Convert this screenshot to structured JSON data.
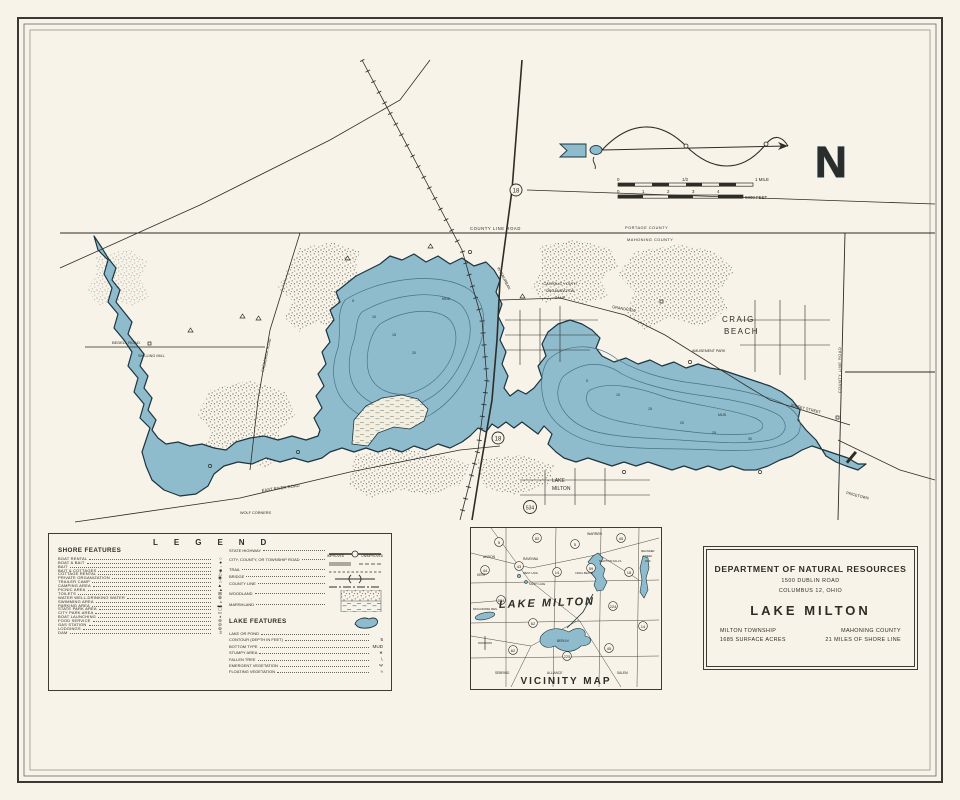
{
  "colors": {
    "paper": "#f7f3e8",
    "water": "#8ebccd",
    "ink": "#2e2c27",
    "contour": "#477484"
  },
  "compass": {
    "n": "N"
  },
  "scalebar": {
    "zero": "0",
    "half": "1/2",
    "mile": "1 MILE",
    "feet_ticks": [
      "0",
      "1",
      "2",
      "3",
      "4"
    ],
    "feet": "5000 FEET"
  },
  "map": {
    "county_line_road": "COUNTY LINE ROAD",
    "portage_county": "PORTAGE COUNTY",
    "mahoning_county": "MAHONING COUNTY",
    "county_line_road_vertical": "COUNTY LINE ROAD",
    "bedell_road": "BEDELL ROAD",
    "shilling_mill": "SHILLING MILL",
    "frederick_road": "FREDERICK ROAD",
    "east_river_road": "EAST RIVER ROAD",
    "wolf_corners": "WOLF CORNERS",
    "interurban": "INTERURBAN",
    "cyo_camp_1": "CATHOLIC YOUTH",
    "cyo_camp_2": "ORGANIZATION",
    "cyo_camp_3": "CAMP",
    "grandview": "GRANDVIEW",
    "jersey_street": "JERSEY STREET",
    "craig_beach_1": "CRAIG",
    "craig_beach_2": "BEACH",
    "amusement_park": "AMUSEMENT PARK",
    "village_1": "LAKE",
    "village_2": "MILTON",
    "pricetown": "PRICETOWN",
    "mud": "MUD",
    "route_18": "18",
    "route_534": "534",
    "depths": [
      "5",
      "10",
      "15",
      "20",
      "5",
      "10",
      "15",
      "20",
      "25",
      "30"
    ]
  },
  "legend": {
    "title": "LEGEND",
    "shore_title": "SHORE FEATURES",
    "shore": [
      {
        "label": "BOAT RENTAL",
        "symbol": "○"
      },
      {
        "label": "BOAT & BAIT",
        "symbol": "●"
      },
      {
        "label": "BAIT",
        "symbol": "◦"
      },
      {
        "label": "BAIT & COTTAGES",
        "symbol": "■"
      },
      {
        "label": "COTTAGE RENTAL",
        "symbol": "△"
      },
      {
        "label": "PRIVATE ORGANIZATION",
        "symbol": "◉"
      },
      {
        "label": "TRAILER CAMP",
        "symbol": "⌂"
      },
      {
        "label": "CAMPING AREA",
        "symbol": "▲"
      },
      {
        "label": "PICNIC AREA",
        "symbol": "▴"
      },
      {
        "label": "TOILETS",
        "symbol": "⊞"
      },
      {
        "label": "WATER WELL-DRINKING WATER",
        "symbol": "⊕"
      },
      {
        "label": "SWIMMING AREA",
        "symbol": "▵"
      },
      {
        "label": "PARKING AREA",
        "symbol": "▬"
      },
      {
        "label": "STATE PARK AREA",
        "symbol": "◻"
      },
      {
        "label": "CITY PARK AREA",
        "symbol": "▭"
      },
      {
        "label": "BOAT LAUNCHING",
        "symbol": "◐"
      },
      {
        "label": "FOOD SERVICE",
        "symbol": "⊖"
      },
      {
        "label": "GAS STATION",
        "symbol": "⊘"
      },
      {
        "label": "LODGINGS",
        "symbol": "⊚"
      },
      {
        "label": "DAM",
        "symbol": "≡"
      }
    ],
    "roads": [
      {
        "label": "STATE HIGHWAY"
      },
      {
        "label": "CITY, COUNTY, OR TOWNSHIP ROAD",
        "sub1": "IMPROVED",
        "sub2": "UNIMPROVED"
      },
      {
        "label": "TRAIL"
      },
      {
        "label": "BRIDGE"
      },
      {
        "label": "COUNTY LINE"
      },
      {
        "label": "WOODLAND"
      },
      {
        "label": "MARSHLAND"
      }
    ],
    "lake_title": "LAKE FEATURES",
    "lake": [
      {
        "label": "LAKE OR POND",
        "symbol": ""
      },
      {
        "label": "CONTOUR (DEPTH IN FEET)",
        "symbol": "5"
      },
      {
        "label": "BOTTOM TYPE",
        "symbol": "MUD"
      },
      {
        "label": "STUMPY AREA",
        "symbol": "∗"
      },
      {
        "label": "FALLEN TREE",
        "symbol": "∖"
      },
      {
        "label": "EMERGENT VEGETATION",
        "symbol": "Ψ"
      },
      {
        "label": "FLOATING VEGETATION",
        "symbol": "≈"
      }
    ]
  },
  "vicinity": {
    "caption": "VICINITY MAP",
    "big_label": "LAKE MILTON",
    "towns": {
      "warren": "WARREN",
      "newton_falls": "NEWTON FALLS",
      "akron": "AKRON",
      "kent": "KENT",
      "ravenna": "RAVENNA",
      "west_lake": "WEST LAKE",
      "sandy_lake": "SANDY LAKE",
      "mogadore": "MOGADORE RES.",
      "craig_beach": "CRAIG BEACH",
      "meander_1": "MEANDER",
      "meander_2": "CREEK",
      "meander_3": "RES.",
      "berlin": "BERLIN",
      "alliance": "ALLIANCE",
      "sebring": "SEBRING",
      "salem": "SALEM"
    },
    "routes": [
      "5",
      "82",
      "5",
      "45",
      "44",
      "43",
      "14",
      "59",
      "18",
      "534",
      "224",
      "62",
      "14",
      "62",
      "225",
      "45"
    ]
  },
  "title_block": {
    "department": "DEPARTMENT OF NATURAL RESOURCES",
    "address_1": "1500 DUBLIN ROAD",
    "address_2": "COLUMBUS 12, OHIO",
    "lake_name": "LAKE MILTON",
    "township": "MILTON TOWNSHIP",
    "county": "MAHONING COUNTY",
    "acres": "1685  SURFACE ACRES",
    "shoreline": "21  MILES OF SHORE LINE"
  }
}
